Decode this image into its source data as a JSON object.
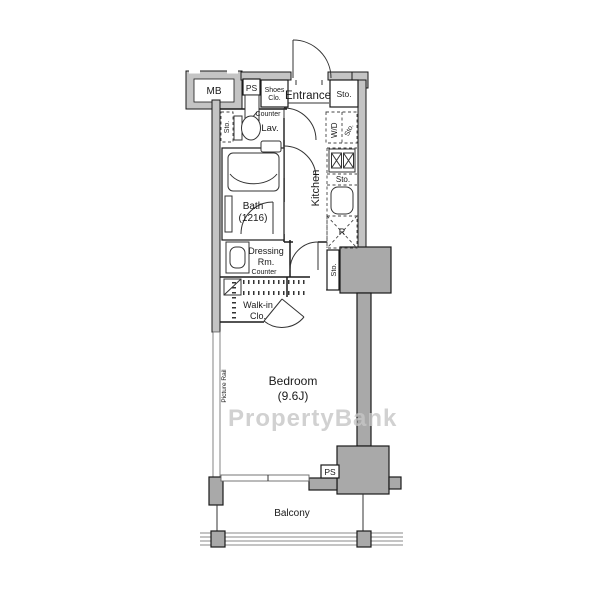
{
  "watermark": "PropertyBank",
  "colors": {
    "outer_wall": "#c4c4c4",
    "pillar": "#a9a9a9",
    "line": "#1a1a1a",
    "watermark": "#c6c6c6"
  },
  "rooms": {
    "entrance": "Entrance",
    "lavatory": "Lav.",
    "bath": "Bath",
    "bath_size": "(1216)",
    "kitchen": "Kitchen",
    "dressing_line1": "Dressing",
    "dressing_line2": "Rm.",
    "walkin_line1": "Walk-in",
    "walkin_line2": "Clo.",
    "bedroom": "Bedroom",
    "bedroom_size": "(9.6J)",
    "balcony": "Balcony"
  },
  "labels": {
    "mb": "MB",
    "ps_top": "PS",
    "ps_bottom": "PS",
    "shoes_line1": "Shoes",
    "shoes_line2": "Clo.",
    "sto_entrance": "Sto.",
    "sto_lav": "Sto.",
    "sto_wd": "Sto.",
    "sto_kitchen_upper": "Sto.",
    "sto_kitchen_lower": "Sto.",
    "wd": "W/D",
    "fridge": "R",
    "counter_entry": "Counter",
    "counter_dressing": "Counter",
    "picture_rail": "Picture Rail"
  }
}
